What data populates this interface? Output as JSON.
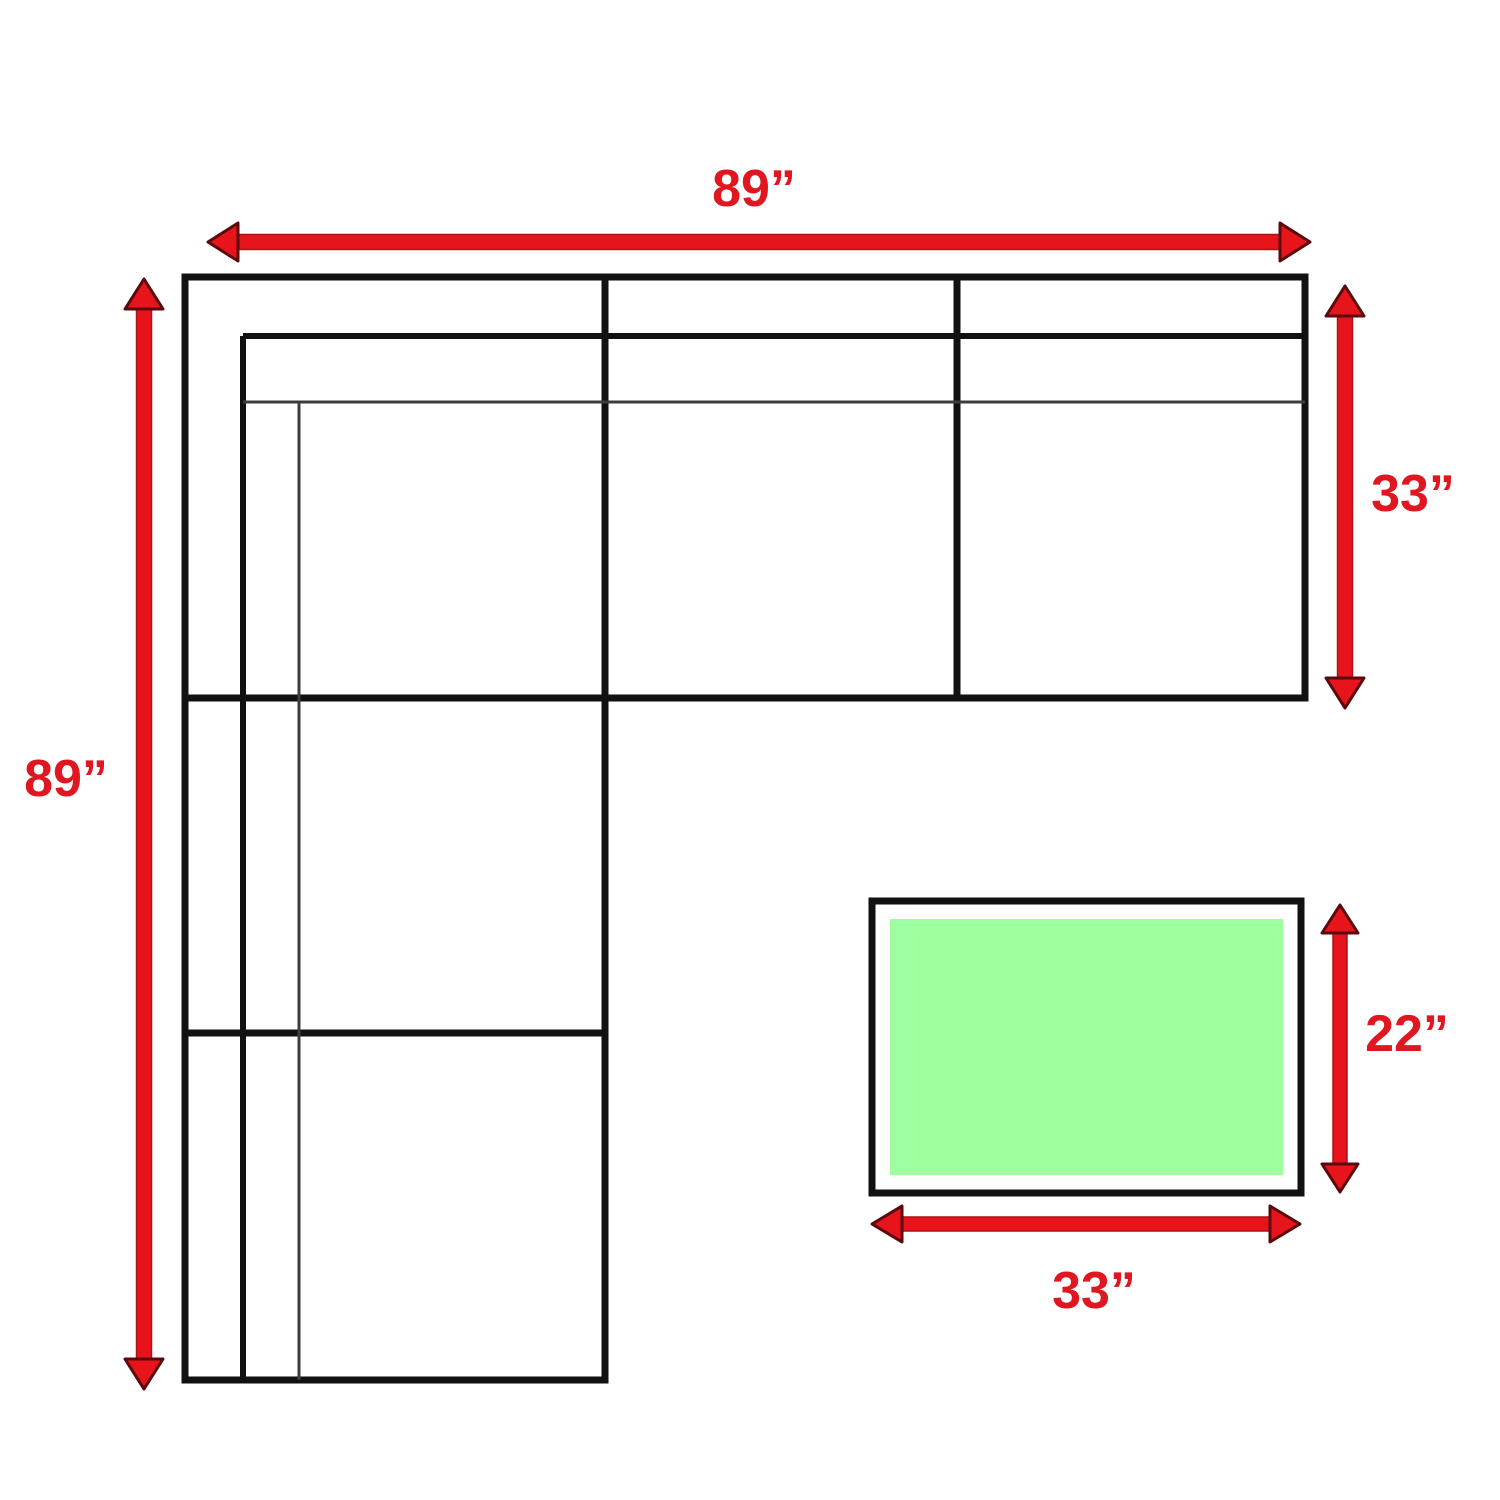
{
  "diagram": {
    "measurements": {
      "sofa_width": "89”",
      "sofa_depth": "89”",
      "sofa_section_depth": "33”",
      "ottoman_depth": "22”",
      "ottoman_width": "33”"
    },
    "colors": {
      "line_black": "#111111",
      "line_gray": "#3d3d3d",
      "arrow_red": "#e8141c",
      "arrow_outline": "#5a0a0d",
      "arrow_edge": "#b01218",
      "label_red": "#e01720",
      "ottoman_green": "#9dff9f",
      "background": "#ffffff"
    }
  }
}
